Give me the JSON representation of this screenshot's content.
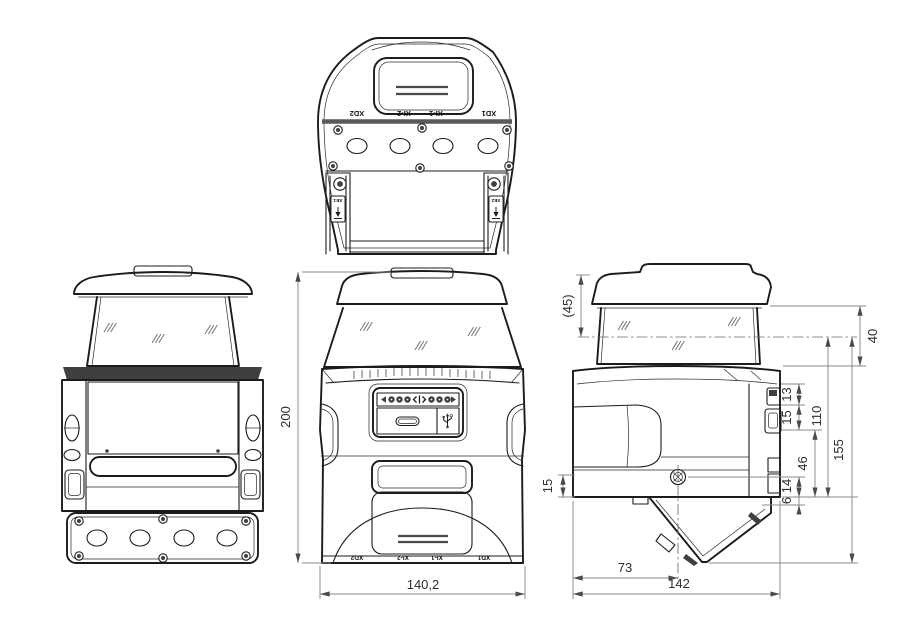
{
  "drawing": {
    "type": "technical dimension drawing",
    "subject": "safety laser scanner, four orthographic views",
    "background": "#ffffff",
    "line_color": "#1c1c1c",
    "dim_color": "#8a8a8a"
  },
  "top_view": {
    "connector_labels": [
      "XD2",
      "XI-2",
      "XI-1",
      "XD1"
    ],
    "earth_labels": [
      "XE1",
      "XE2"
    ]
  },
  "front_view": {
    "connector_labels": [
      "XD2",
      "XI-2",
      "XI-1",
      "XD1"
    ],
    "dims": {
      "height": "200",
      "width": "140,2"
    }
  },
  "side_view": {
    "dims": {
      "cap_height": "(45)",
      "hood_height": "40",
      "conn_top": "13",
      "conn_mid": "15",
      "scan_to_base": "110",
      "overall": "155",
      "lower_body": "46",
      "screw_to_base": "14",
      "base_step": "6",
      "front_step": "15",
      "screw_offset": "73",
      "depth": "142"
    }
  }
}
